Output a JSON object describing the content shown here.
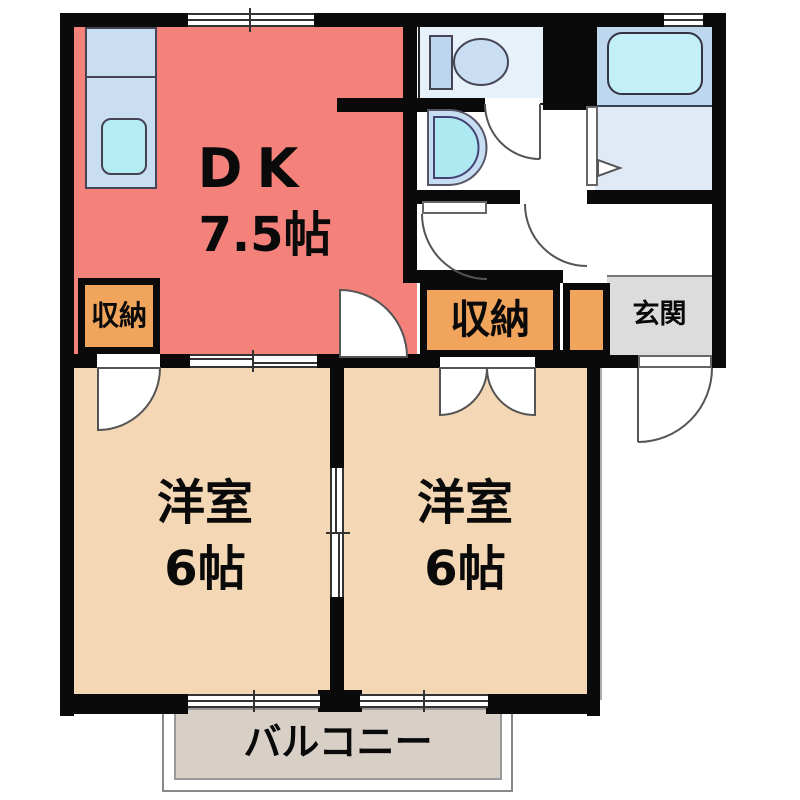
{
  "floor_plan": {
    "dk": {
      "name": "DK",
      "size": "7.5帖"
    },
    "western_room_left": {
      "name": "洋室",
      "size": "6帖"
    },
    "western_room_right": {
      "name": "洋室",
      "size": "6帖"
    },
    "storage_left": {
      "label": "収納"
    },
    "storage_center": {
      "label": "収納"
    },
    "entrance": {
      "label": "玄関"
    },
    "balcony": {
      "label": "バルコニー"
    },
    "colors": {
      "wall": "#0a0a0a",
      "dk_fill": "#F5817B",
      "room_fill": "#F4D7B4",
      "storage_fill": "#F1A45C",
      "entrance_fill": "#DCDCDC",
      "balcony_fill": "#D8CFC6",
      "bath_fill": "#BDD7EE",
      "fixture_cyan": "#AEE9F2",
      "counter_blue": "#CADEF2"
    }
  }
}
